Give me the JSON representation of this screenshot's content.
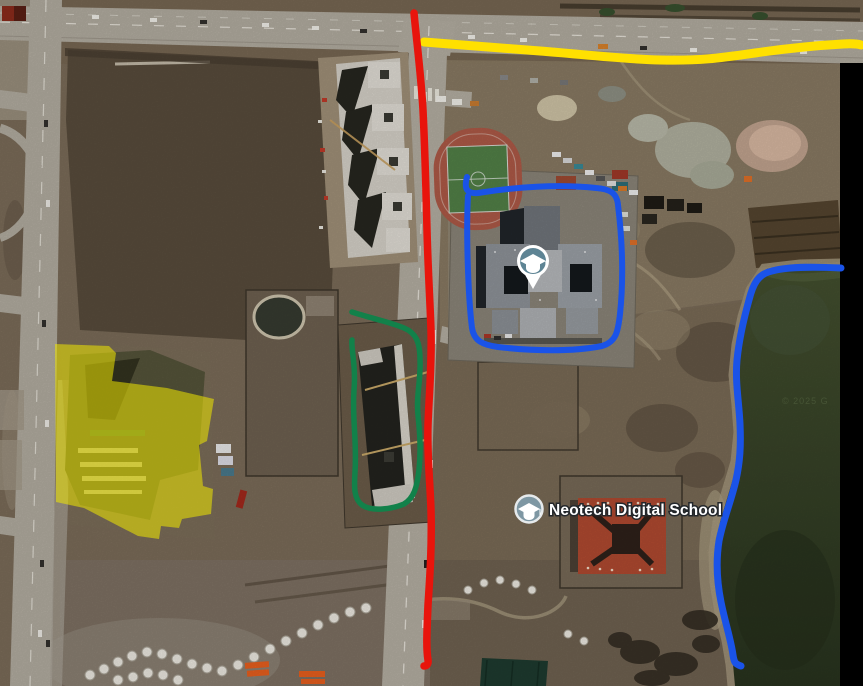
{
  "map": {
    "poi_label": {
      "title": "Neotech Digital School",
      "icon": "graduation-cap-icon"
    },
    "marker": {
      "icon": "graduation-cap-icon",
      "pin_color": "#5E8494",
      "badge_color": "#7E97A3"
    },
    "watermark": "© 2025 G",
    "annotations": {
      "yellow_route": {
        "color": "#FFE000"
      },
      "red_route": {
        "color": "#E8140C"
      },
      "blue_building_outline": {
        "color": "#1A53E8"
      },
      "green_building_outline": {
        "color": "#12814A"
      },
      "yellow_area_highlight": {
        "color": "#F0E800"
      },
      "blue_lakeshore_route": {
        "color": "#1A53E8"
      }
    }
  }
}
